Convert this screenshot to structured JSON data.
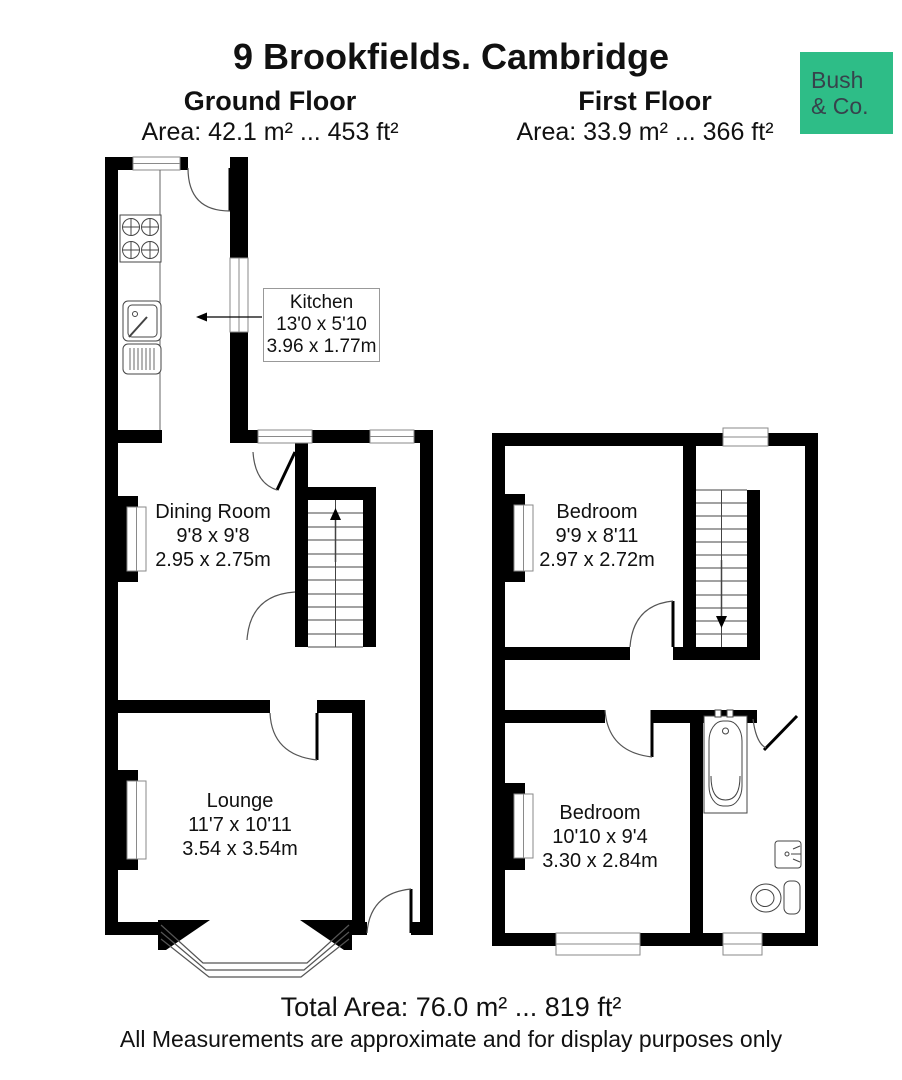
{
  "header": {
    "title": "9 Brookfields. Cambridge",
    "ground_floor": {
      "name": "Ground Floor",
      "area": "Area: 42.1 m² ... 453 ft²"
    },
    "first_floor": {
      "name": "First Floor",
      "area": "Area: 33.9 m² ... 366 ft²"
    },
    "logo": {
      "line1": "Bush",
      "line2": "& Co.",
      "bg_color": "#2EBD87",
      "text_color": "#37424C"
    }
  },
  "rooms": {
    "kitchen": {
      "name": "Kitchen",
      "imperial": "13'0 x 5'10",
      "metric": "3.96 x 1.77m"
    },
    "dining": {
      "name": "Dining Room",
      "imperial": "9'8 x 9'8",
      "metric": "2.95 x 2.75m"
    },
    "lounge": {
      "name": "Lounge",
      "imperial": "11'7 x 10'11",
      "metric": "3.54 x 3.54m"
    },
    "bedroom1": {
      "name": "Bedroom",
      "imperial": "9'9 x 8'11",
      "metric": "2.97 x 2.72m"
    },
    "bedroom2": {
      "name": "Bedroom",
      "imperial": "10'10 x 9'4",
      "metric": "3.30 x 2.84m"
    }
  },
  "footer": {
    "total_area": "Total Area: 76.0 m²  ...  819 ft²",
    "disclaimer": "All Measurements are approximate and for display purposes only"
  }
}
